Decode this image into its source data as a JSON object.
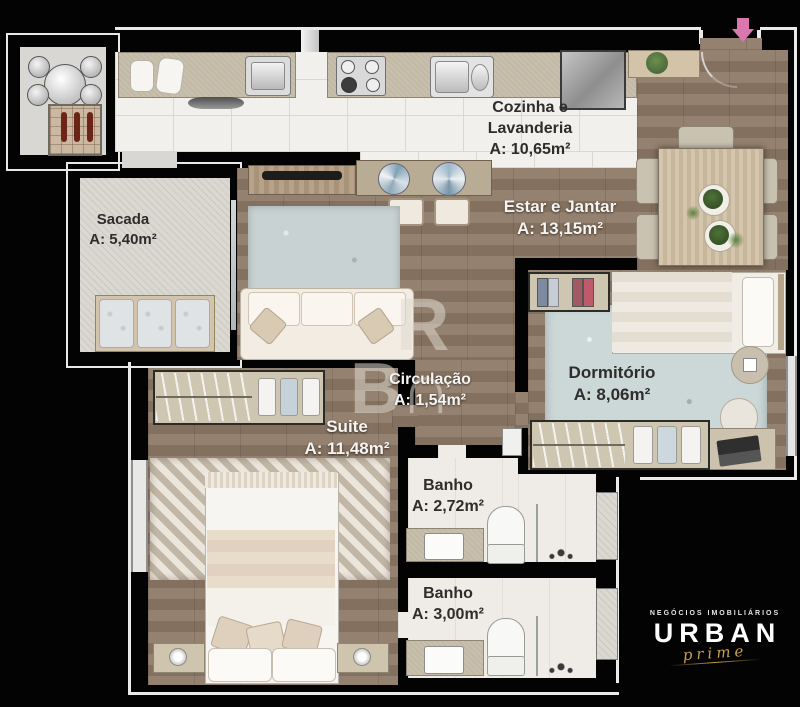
{
  "rooms": {
    "sacada": {
      "name": "Sacada",
      "area": "A: 5,40m²"
    },
    "cozinha": {
      "name_line1": "Cozinha e",
      "name_line2": "Lavanderia",
      "area": "A: 10,65m²"
    },
    "estar": {
      "name": "Estar e Jantar",
      "area": "A: 13,15m²"
    },
    "circulacao": {
      "name": "Circulação",
      "area": "A: 1,54m²"
    },
    "dormitorio": {
      "name": "Dormitório",
      "area": "A: 8,06m²"
    },
    "suite": {
      "name": "Suite",
      "area": "A: 11,48m²"
    },
    "banho1": {
      "name": "Banho",
      "area": "A: 2,72m²"
    },
    "banho2": {
      "name": "Banho",
      "area": "A: 3,00m²"
    }
  },
  "watermark": {
    "line1": "R",
    "line2": "B∩"
  },
  "logo": {
    "tagline": "NEGÓCIOS IMOBILIÁRIOS",
    "brand": "URBAN",
    "script": "prime"
  },
  "colors": {
    "entrance_arrow": "#d878ac",
    "logo_gold": "#c8a04b",
    "background": "#030303"
  }
}
